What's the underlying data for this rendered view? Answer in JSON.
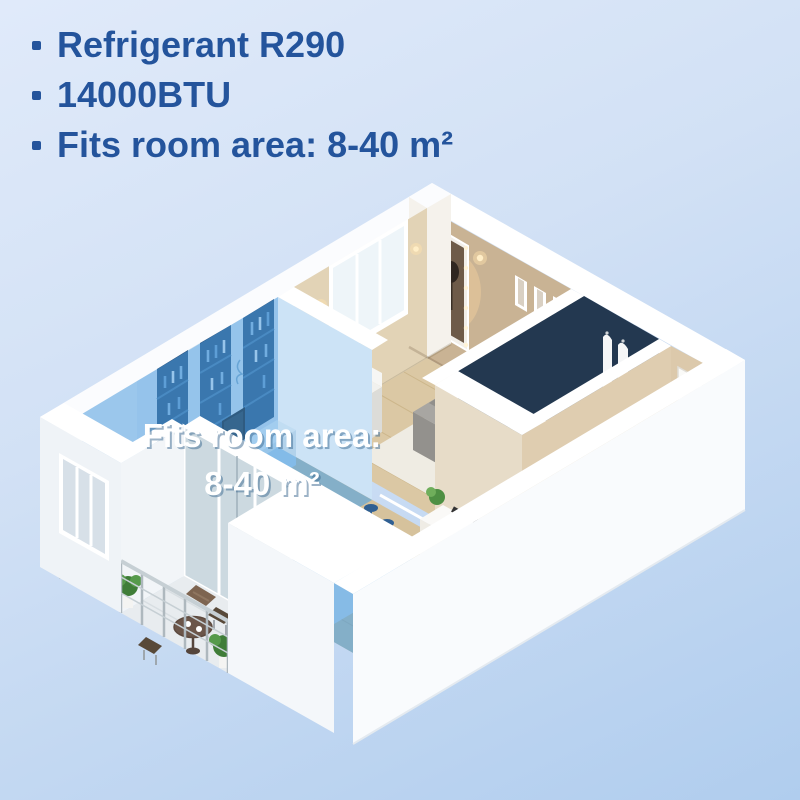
{
  "page": {
    "background_top_color": "#e0eafa",
    "background_bottom_color": "#b0cdee"
  },
  "features": {
    "text_color": "#24549c",
    "items": [
      {
        "text": "Refrigerant R290"
      },
      {
        "text": "14000BTU"
      },
      {
        "text": "Fits room area: 8-40 m²"
      }
    ]
  },
  "floorplan_overlay": {
    "line1": "Fits room area:",
    "line2": "8-40 m²",
    "text_color": "#ffffff",
    "highlight_color": "#4da2e6"
  }
}
